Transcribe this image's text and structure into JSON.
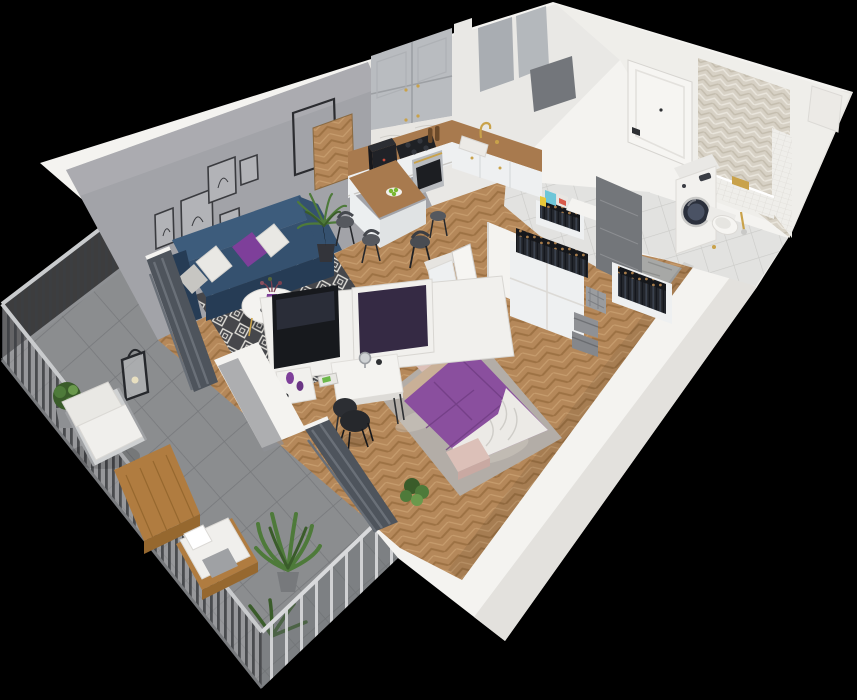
{
  "canvas": {
    "width": 857,
    "height": 700,
    "background": "#000000"
  },
  "colors": {
    "background": "#000000",
    "wall_white": "#f4f3f0",
    "wall_white_shade": "#e3e1dd",
    "wall_inner": "#efeeea",
    "kitchen_wall": "#e9e8e5",
    "wall_gray": "#a2a3a8",
    "wall_gray_dark": "#8f9094",
    "tile_wall_dark": "#73767a",
    "floor_wood": "#b5885a",
    "floor_wood_dark": "#9d7244",
    "floor_wood_light": "#c79d6e",
    "floor_tile": "#e2e2e0",
    "floor_tile_grout": "#cbcbc8",
    "balcony_tile": "#9b9da0",
    "balcony_tile_dark": "#85878a",
    "fence_slat": "#3c3e42",
    "curtain_dark": "#4e545c",
    "curtain_mid": "#6a7078",
    "sofa_navy": "#35516f",
    "sofa_navy_dark": "#263c55",
    "sofa_navy_light": "#3d5c7c",
    "pillow_white": "#e9e8e4",
    "pillow_gray": "#c7c6c2",
    "accent_purple": "#7e3f9a",
    "bed_purple": "#8a4f9e",
    "bed_purple_dark": "#6f3c82",
    "sheet_white": "#eceae6",
    "sheet_shadow": "#cfcdc8",
    "bench_pink": "#dcc0b8",
    "headboard_wood": "#c9b097",
    "rug_dark": "#46474b",
    "rug_light": "#e2e0da",
    "bedroom_rug": "#b3ada7",
    "counter_wood": "#a87a4e",
    "cabinet_gray": "#b9bcc0",
    "cabinet_line": "#9da0a4",
    "cabinet_white": "#eef0f1",
    "appliance_black": "#1f2125",
    "steel": "#b8bbbf",
    "gold": "#c9a24a",
    "marble": "#e8e6e2",
    "tile_beige": "#d7d1c5",
    "tile_beige_dark": "#c4bdae",
    "plant_green": "#4e7a3a",
    "plant_green_dark": "#3a5c2a",
    "plant_green_light": "#6a994c",
    "clothes_dark": "#23262c",
    "hanger_wood": "#a87c4a",
    "box_gray": "#8f9195",
    "box_cyan": "#6ec6d8",
    "box_red": "#d85a4a",
    "apple_green": "#7ab832",
    "chair_black": "#26282c",
    "door_white": "#f6f5f2",
    "tv_black": "#17191d",
    "tv_purple": "#352a44",
    "outdoor_wood": "#b07c40",
    "outdoor_wood_dark": "#96682f",
    "table_white": "#f4f3f0"
  },
  "scene": {
    "type": "isometric-apartment-3d-floorplan",
    "rooms": [
      {
        "name": "living-room",
        "items": [
          "navy-sofa",
          "throw-pillows",
          "round-coffee-table",
          "purple-vase",
          "diamond-rug",
          "tv",
          "palm-plant",
          "wall-art-frames",
          "wood-panel-squares"
        ]
      },
      {
        "name": "kitchen",
        "items": [
          "upper-cabinets",
          "marble-backsplash",
          "wood-counter",
          "cooktop",
          "oven",
          "coffee-machine",
          "sink",
          "gold-faucet",
          "bar-table",
          "bar-stools",
          "apple-plate"
        ]
      },
      {
        "name": "hallway",
        "items": [
          "open-wardrobes",
          "clothes-racks",
          "storage-boxes",
          "fabric-basket",
          "entry-door"
        ]
      },
      {
        "name": "bathroom",
        "items": [
          "washing-machine",
          "wall-hung-toilet",
          "herringbone-tile-wall",
          "white-tile-wall",
          "gold-flush-plate"
        ]
      },
      {
        "name": "bedroom",
        "items": [
          "purple-bed",
          "white-duvet",
          "pink-bench",
          "gray-rug",
          "desk",
          "desk-chair",
          "mirror",
          "purple-vases",
          "wardrobe",
          "open-door",
          "plant",
          "dark-curtains"
        ]
      },
      {
        "name": "balcony",
        "items": [
          "slat-railing",
          "outdoor-armchair",
          "wood-coffee-table",
          "wood-daybed",
          "boxwood-plant",
          "leafy-plant",
          "lantern"
        ]
      }
    ]
  }
}
